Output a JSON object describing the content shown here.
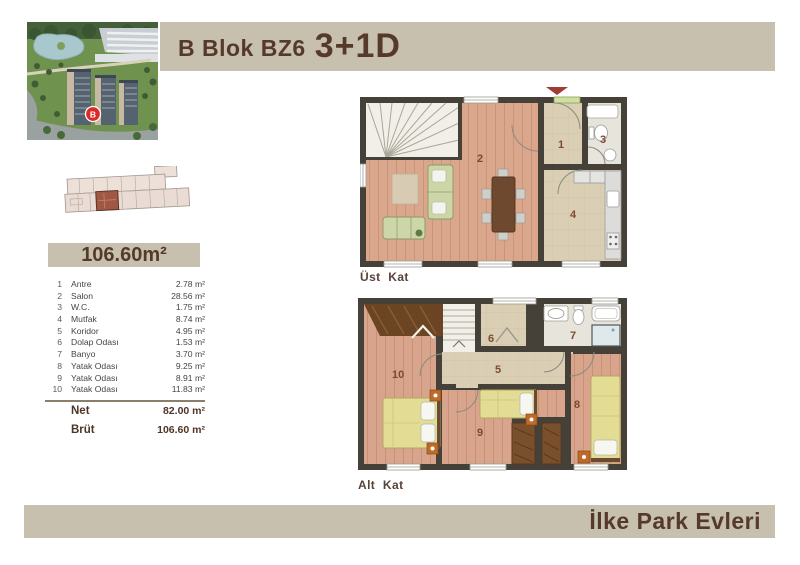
{
  "header": {
    "title_block": "B Blok BZ6",
    "title_unit": "3+1D",
    "photo_marker": "B"
  },
  "summary": {
    "total_area": "106.60m²"
  },
  "room_table": {
    "rows": [
      {
        "no": "1",
        "name": "Antre",
        "area": "2.78 m²"
      },
      {
        "no": "2",
        "name": "Salon",
        "area": "28.56 m²"
      },
      {
        "no": "3",
        "name": "W.C.",
        "area": "1.75 m²"
      },
      {
        "no": "4",
        "name": "Mutfak",
        "area": "8.74 m²"
      },
      {
        "no": "5",
        "name": "Koridor",
        "area": "4.95 m²"
      },
      {
        "no": "6",
        "name": "Dolap Odası",
        "area": "1.53 m²"
      },
      {
        "no": "7",
        "name": "Banyo",
        "area": "3.70 m²"
      },
      {
        "no": "8",
        "name": "Yatak Odası",
        "area": "9.25 m²"
      },
      {
        "no": "9",
        "name": "Yatak Odası",
        "area": "8.91 m²"
      },
      {
        "no": "10",
        "name": "Yatak Odası",
        "area": "11.83 m²"
      }
    ],
    "net_label": "Net",
    "net_value": "82.00 m²",
    "brut_label": "Brüt",
    "brut_value": "106.60 m²"
  },
  "plans": {
    "upper": {
      "label": "Üst Kat",
      "rooms": {
        "r1": "1",
        "r2": "2",
        "r3": "3",
        "r4": "4"
      }
    },
    "lower": {
      "label": "Alt Kat",
      "rooms": {
        "r5": "5",
        "r6": "6",
        "r7": "7",
        "r8": "8",
        "r9": "9",
        "r10": "10"
      }
    }
  },
  "footer": {
    "brand": "İlke Park Evleri"
  },
  "colors": {
    "bar_beige": "#c7c0ae",
    "accent_brown": "#553a2b",
    "wall": "#454139",
    "wood_floor": "#daa78c",
    "beige_floor": "#dacfb4",
    "highlight_unit": "#a05844",
    "marker_red": "#d92b27",
    "arrow_red": "#a03c34"
  }
}
